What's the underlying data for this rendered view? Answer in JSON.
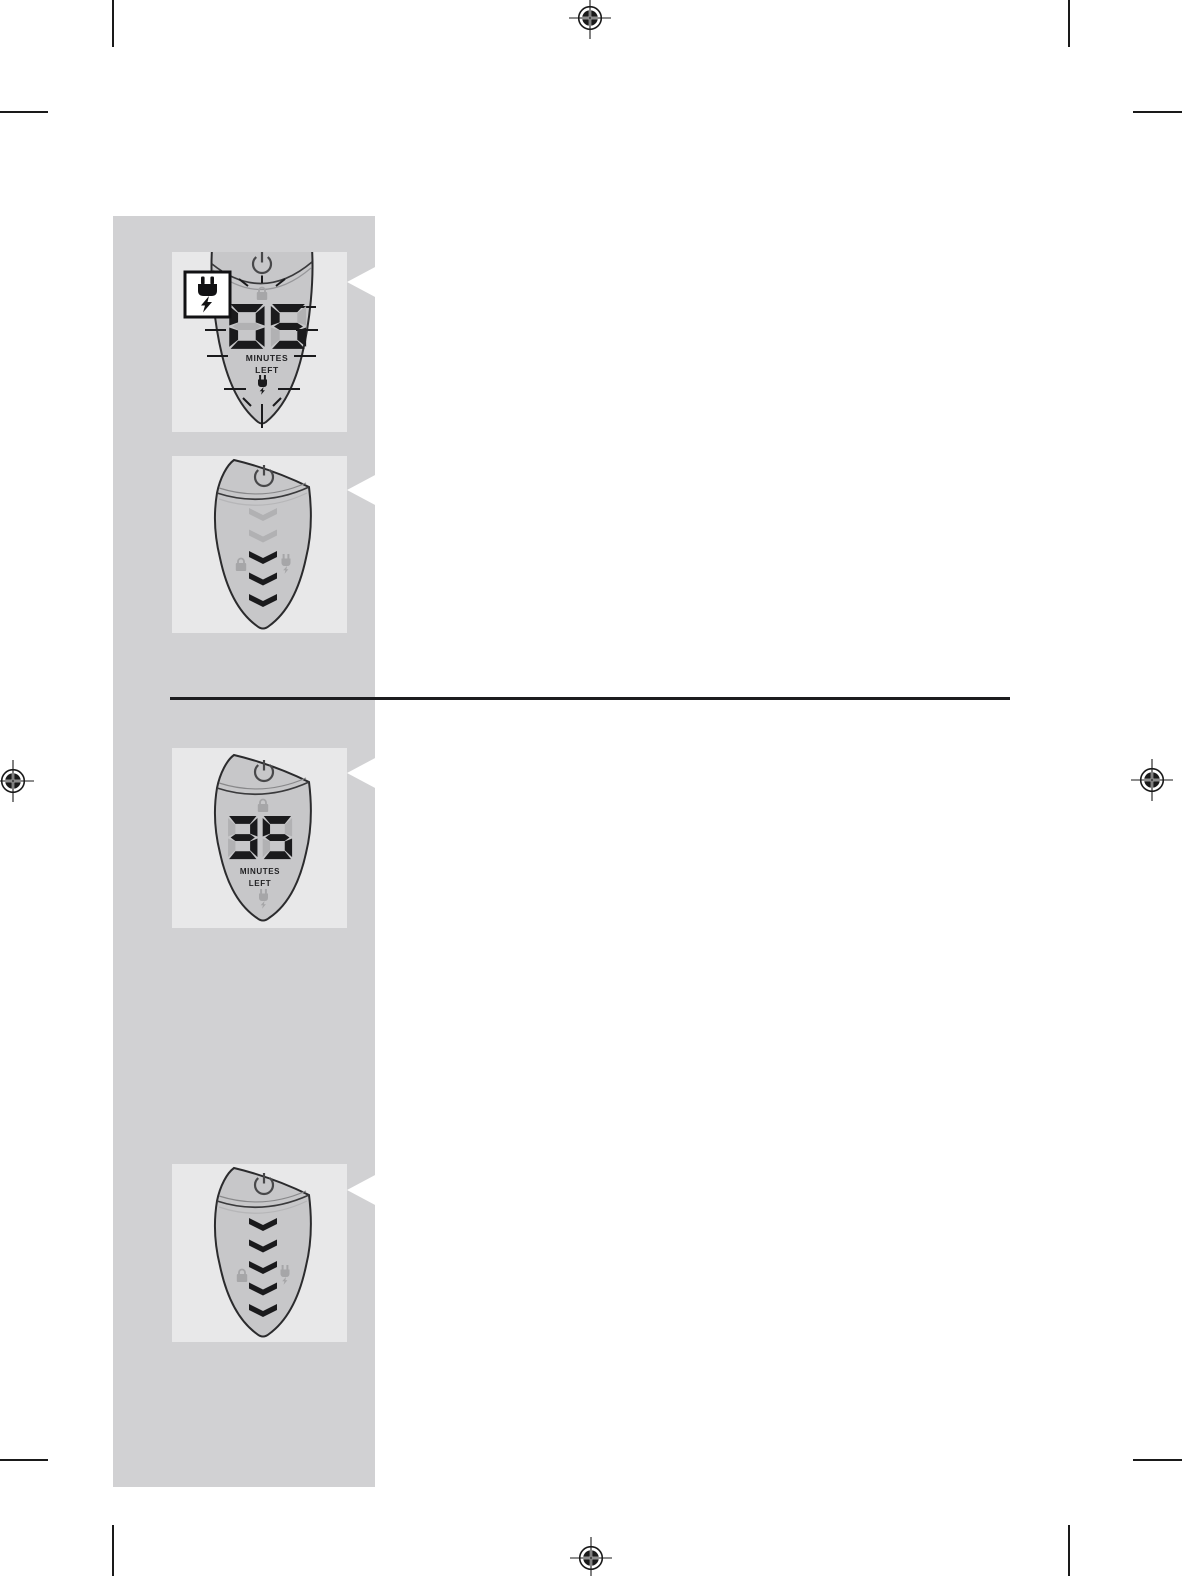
{
  "document": {
    "kind": "shaver-manual-illustration-page"
  },
  "colors": {
    "page_bg": "#ffffff",
    "sidebar_bg": "#d1d1d3",
    "panel_bg": "#e8e8e9",
    "device_body": "#c7c7c9",
    "device_outline": "#2b2b2d",
    "segment_on": "#1a1a1c",
    "segment_off": "#b1b1b3",
    "icon_inactive": "#a6a6a8",
    "icon_active": "#1a1a1c",
    "power_glyph": "#48484a",
    "mark": "#1a1a1a"
  },
  "panels": [
    {
      "name": "display-5-minutes-flashing",
      "display_value": "05",
      "unit_label_1": "MINUTES",
      "unit_label_2": "LEFT",
      "badge_icon": "plug-lightning-icon",
      "flashing": true
    },
    {
      "name": "charge-level-3-of-5",
      "chevrons": [
        false,
        false,
        true,
        true,
        true
      ]
    },
    {
      "name": "display-35-minutes",
      "display_value": "35",
      "unit_label_1": "MINUTES",
      "unit_label_2": "LEFT"
    },
    {
      "name": "charge-level-5-of-5",
      "chevrons": [
        true,
        true,
        true,
        true,
        true
      ]
    }
  ]
}
